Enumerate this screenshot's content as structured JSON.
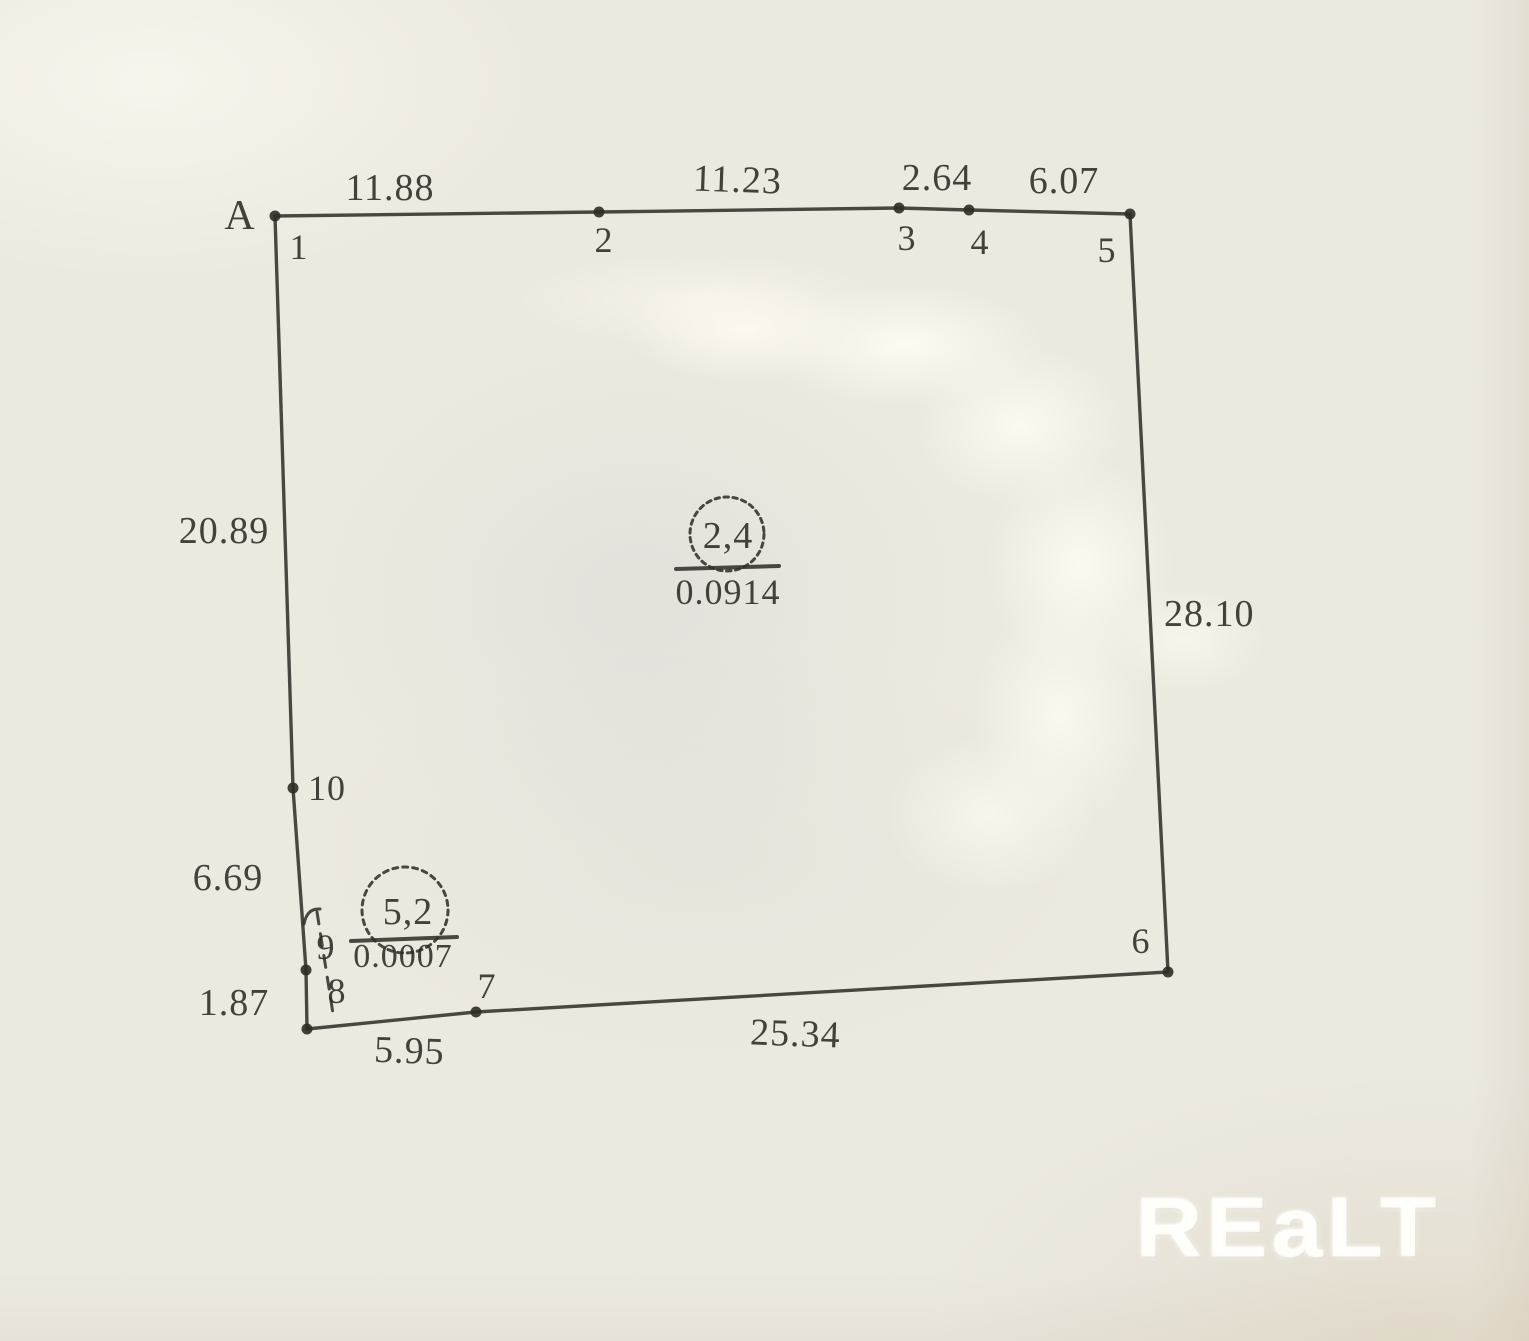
{
  "plan": {
    "corner_point_label": "A",
    "vertex_labels": [
      "1",
      "2",
      "3",
      "4",
      "5",
      "6",
      "7",
      "8",
      "9",
      "10"
    ],
    "side_lengths": {
      "s1_2": "11.88",
      "s2_3": "11.23",
      "s3_4": "2.64",
      "s4_5": "6.07",
      "s5_6": "28.10",
      "s6_7": "25.34",
      "s7_8": "5.95",
      "s8_9": "1.87",
      "s9_10": "6.69",
      "s10_1": "20.89"
    },
    "parcels": [
      {
        "number": "2,4",
        "area": "0.0914"
      },
      {
        "number": "5,2",
        "area": "0.0007"
      }
    ]
  },
  "watermark": {
    "text": "REaLT"
  },
  "colors": {
    "ink": "#2b2923",
    "paper": "#ece9e0",
    "watermark": "#fffffc"
  }
}
